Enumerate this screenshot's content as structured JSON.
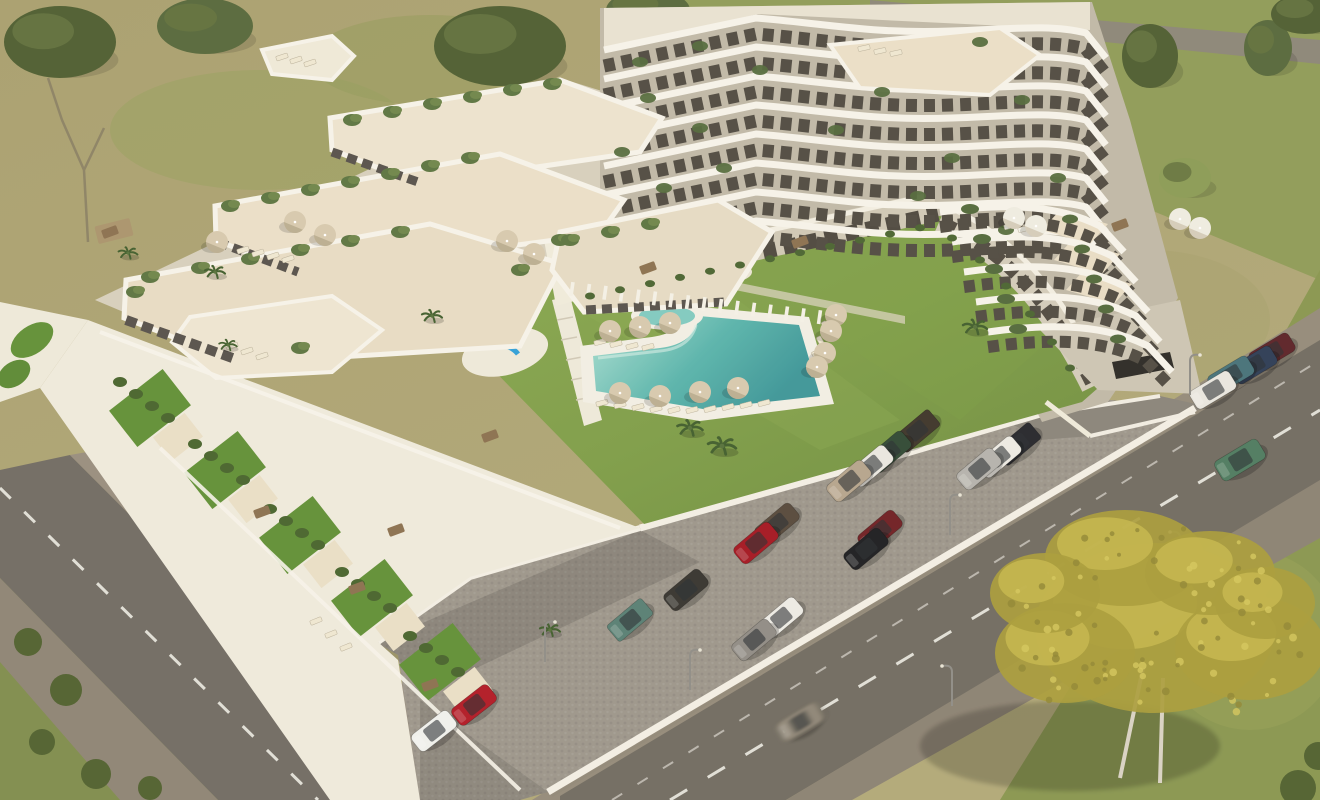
{
  "scene": {
    "description": "Aerial 3D render of a white terraced apartment complex with stepped balconies, central lawn courtyard, L-shaped turquoise pool, round kiddie pool, blue playground, cobbled parking lot with cars, perimeter roads with street lamps, dry grass fields and a large yellow-leaved tree",
    "palette": {
      "dry_grass": "#a69d6c",
      "green_grass": "#8e9a57",
      "lawn_light": "#93b156",
      "lawn_dark": "#6f8f40",
      "asphalt": "#6f6a62",
      "sidewalk": "#93897a",
      "parking_cobble": "#9b958b",
      "building_white": "#f4f1e8",
      "building_wall": "#bfb8a7",
      "terrace_floor": "#e9dfc8",
      "window_dark": "#4e4941",
      "plant_green": "#51683a",
      "hedge_green": "#486230",
      "pool_shallow": "#aadfd2",
      "pool_deep": "#3b9598",
      "deck_white": "#f2efe5",
      "umbrella_beige": "#d6c9ae",
      "umbrella_white": "#efece2",
      "playground_blue": "#2e9fd8",
      "tree_yellow": "#b5a83e",
      "tree_green": "#4c5c30",
      "lane_mark": "#f5f3ec"
    }
  },
  "building": {
    "tall_block": {
      "floors": 8,
      "y0": 16,
      "dy": 29
    },
    "right_wing": {
      "floors": 5
    },
    "facade_plants": [
      [
        640,
        62
      ],
      [
        700,
        128
      ],
      [
        664,
        188
      ],
      [
        622,
        152
      ],
      [
        980,
        42
      ],
      [
        1022,
        100
      ],
      [
        952,
        158
      ],
      [
        882,
        92
      ],
      [
        1058,
        178
      ],
      [
        700,
        46
      ],
      [
        760,
        70
      ],
      [
        836,
        130
      ],
      [
        918,
        196
      ],
      [
        1006,
        230
      ],
      [
        648,
        98
      ],
      [
        724,
        168
      ]
    ],
    "slab_plants": [
      [
        352,
        120
      ],
      [
        392,
        112
      ],
      [
        432,
        104
      ],
      [
        472,
        97
      ],
      [
        512,
        90
      ],
      [
        552,
        84
      ],
      [
        230,
        206
      ],
      [
        270,
        198
      ],
      [
        310,
        190
      ],
      [
        350,
        182
      ],
      [
        390,
        174
      ],
      [
        430,
        166
      ],
      [
        470,
        158
      ],
      [
        150,
        277
      ],
      [
        200,
        268
      ],
      [
        250,
        259
      ],
      [
        300,
        250
      ],
      [
        350,
        241
      ],
      [
        400,
        232
      ],
      [
        135,
        292
      ],
      [
        300,
        348
      ],
      [
        520,
        270
      ],
      [
        560,
        240
      ],
      [
        570,
        240
      ],
      [
        610,
        232
      ],
      [
        650,
        224
      ]
    ]
  },
  "courtyard": {
    "stripes": {
      "x1": 572,
      "y1": 289,
      "x2": 836,
      "y2": 319,
      "count": 17
    },
    "umbrellas": [
      {
        "x": 610,
        "y": 331
      },
      {
        "x": 640,
        "y": 327
      },
      {
        "x": 670,
        "y": 323
      },
      {
        "x": 620,
        "y": 393
      },
      {
        "x": 660,
        "y": 396
      },
      {
        "x": 700,
        "y": 392
      },
      {
        "x": 738,
        "y": 388
      },
      {
        "x": 836,
        "y": 315
      },
      {
        "x": 831,
        "y": 331
      },
      {
        "x": 825,
        "y": 353
      },
      {
        "x": 817,
        "y": 367
      },
      {
        "x": 217,
        "y": 242
      },
      {
        "x": 295,
        "y": 222
      },
      {
        "x": 325,
        "y": 235
      },
      {
        "x": 507,
        "y": 241
      },
      {
        "x": 534,
        "y": 254
      },
      {
        "x": 1180,
        "y": 219,
        "white": true
      },
      {
        "x": 1200,
        "y": 228,
        "white": true
      },
      {
        "x": 1014,
        "y": 218,
        "white": true
      },
      {
        "x": 1036,
        "y": 226,
        "white": true
      }
    ],
    "loungers": [
      [
        602,
        403,
        -15
      ],
      [
        620,
        405,
        -15
      ],
      [
        638,
        407,
        -15
      ],
      [
        656,
        409,
        -15
      ],
      [
        674,
        410,
        -15
      ],
      [
        692,
        410,
        -15
      ],
      [
        710,
        409,
        -15
      ],
      [
        728,
        407,
        -15
      ],
      [
        746,
        405,
        -15
      ],
      [
        764,
        403,
        -15
      ],
      [
        600,
        342,
        -15
      ],
      [
        616,
        344,
        -15
      ],
      [
        632,
        346,
        -15
      ],
      [
        648,
        347,
        -15
      ],
      [
        826,
        327,
        62
      ],
      [
        821,
        342,
        62
      ],
      [
        816,
        357,
        62
      ],
      [
        811,
        371,
        62
      ],
      [
        243,
        250,
        -18
      ],
      [
        258,
        253,
        -18
      ],
      [
        273,
        256,
        -18
      ],
      [
        288,
        259,
        -18
      ],
      [
        232,
        346,
        -18
      ],
      [
        247,
        351,
        -18
      ],
      [
        262,
        356,
        -18
      ],
      [
        316,
        621,
        -22
      ],
      [
        331,
        634,
        -22
      ],
      [
        346,
        647,
        -22
      ],
      [
        282,
        57,
        -18
      ],
      [
        296,
        60,
        -18
      ],
      [
        310,
        63,
        -18
      ],
      [
        864,
        48,
        -12
      ],
      [
        880,
        51,
        -12
      ],
      [
        896,
        53,
        -12
      ],
      [
        1010,
        226,
        -15,
        1
      ],
      [
        1024,
        229,
        -15,
        1
      ]
    ],
    "tables": [
      [
        110,
        232
      ],
      [
        262,
        512
      ],
      [
        357,
        588
      ],
      [
        430,
        685
      ],
      [
        490,
        436
      ],
      [
        396,
        530
      ],
      [
        1120,
        225
      ],
      [
        648,
        268
      ],
      [
        800,
        242
      ]
    ],
    "palms": [
      [
        690,
        428,
        1
      ],
      [
        722,
        446,
        1.1
      ],
      [
        975,
        327,
        0.95
      ],
      [
        432,
        316,
        0.8
      ],
      [
        128,
        253,
        0.75
      ],
      [
        215,
        272,
        0.8
      ],
      [
        228,
        345,
        0.7
      ],
      [
        550,
        630,
        0.8
      ]
    ]
  },
  "vegetation": {
    "trees": [
      [
        60,
        42,
        56,
        36,
        0
      ],
      [
        205,
        26,
        48,
        28,
        1
      ],
      [
        500,
        46,
        66,
        40,
        0
      ],
      [
        648,
        10,
        42,
        20,
        1
      ],
      [
        1150,
        56,
        28,
        32,
        0
      ],
      [
        1268,
        48,
        24,
        28,
        1
      ],
      [
        1305,
        14,
        34,
        20,
        0
      ],
      [
        1185,
        178,
        26,
        20,
        2
      ]
    ],
    "bushes": [
      [
        28,
        642,
        14
      ],
      [
        66,
        690,
        16
      ],
      [
        42,
        742,
        13
      ],
      [
        96,
        774,
        15
      ],
      [
        150,
        788,
        12
      ],
      [
        1298,
        788,
        18
      ],
      [
        1318,
        756,
        14
      ]
    ],
    "yellow_tree": {
      "x": 1155,
      "y": 628
    }
  },
  "vehicles": {
    "parking": [
      {
        "x": 917,
        "y": 431,
        "c": "#3b3329",
        "k": "suv"
      },
      {
        "x": 889,
        "y": 452,
        "c": "#2e4733"
      },
      {
        "x": 871,
        "y": 466,
        "c": "#e9e7e1"
      },
      {
        "x": 849,
        "y": 481,
        "c": "#b5a48d"
      },
      {
        "x": 1018,
        "y": 444,
        "c": "#23242b",
        "k": "suv"
      },
      {
        "x": 999,
        "y": 457,
        "c": "#eceae4"
      },
      {
        "x": 979,
        "y": 469,
        "c": "#b4b2ad"
      },
      {
        "x": 777,
        "y": 524,
        "c": "#55473a"
      },
      {
        "x": 756,
        "y": 543,
        "c": "#a31520"
      },
      {
        "x": 880,
        "y": 531,
        "c": "#6e1d22"
      },
      {
        "x": 866,
        "y": 549,
        "c": "#1a1b1f"
      },
      {
        "x": 686,
        "y": 590,
        "c": "#34322e"
      },
      {
        "x": 781,
        "y": 618,
        "c": "#edebe6"
      },
      {
        "x": 754,
        "y": 640,
        "c": "#8f8b85"
      },
      {
        "x": 630,
        "y": 620,
        "c": "#567e73",
        "k": "suv"
      },
      {
        "x": 434,
        "y": 731,
        "c": "#f0f1ee",
        "a": -38
      },
      {
        "x": 474,
        "y": 705,
        "c": "#b01824",
        "a": -38
      }
    ],
    "street": [
      {
        "x": 1272,
        "y": 352,
        "c": "#5a2026",
        "a": -31
      },
      {
        "x": 1254,
        "y": 365,
        "c": "#2b3a55",
        "a": -31
      },
      {
        "x": 1231,
        "y": 375,
        "c": "#447079",
        "a": -31
      },
      {
        "x": 1213,
        "y": 390,
        "c": "#e8e6e0",
        "a": -31
      },
      {
        "x": 1240,
        "y": 460,
        "c": "#4c7a5f",
        "a": -31,
        "k": "van"
      },
      {
        "x": 800,
        "y": 722,
        "c": "#8e8577",
        "a": -31,
        "blur": true
      }
    ]
  },
  "lamps": [
    [
      690,
      690,
      1
    ],
    [
      950,
      535,
      1
    ],
    [
      1190,
      395,
      1
    ],
    [
      952,
      706,
      -1
    ],
    [
      1180,
      572,
      -1
    ],
    [
      545,
      662,
      1
    ]
  ]
}
